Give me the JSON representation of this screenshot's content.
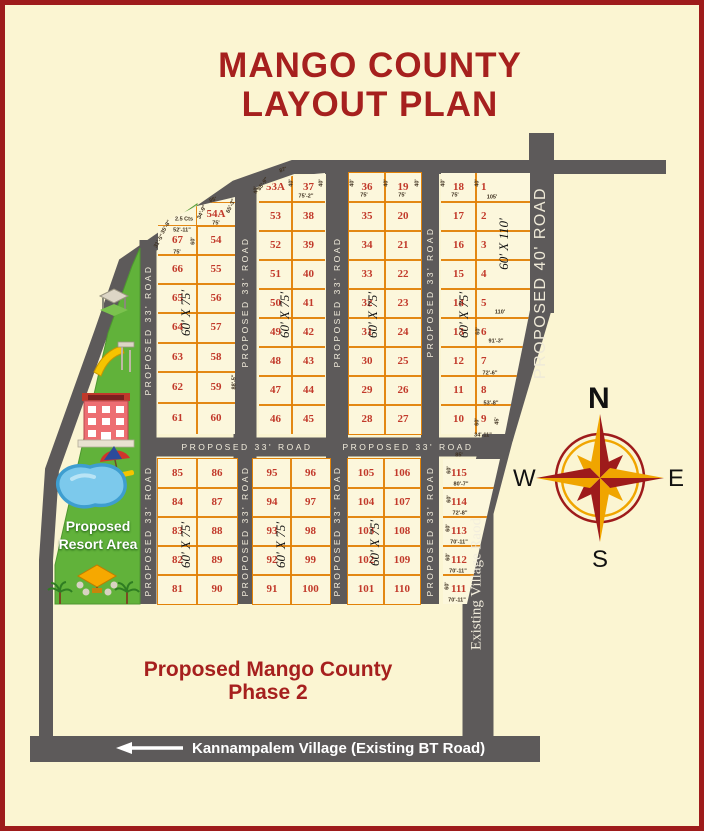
{
  "title": {
    "line1": "MANGO COUNTY",
    "line2": "LAYOUT PLAN"
  },
  "phase2": {
    "line1": "Proposed Mango County",
    "line2": "Phase 2"
  },
  "resort": {
    "line1": "Proposed",
    "line2": "Resort Area",
    "odd_plot_label": "2.5 Cts"
  },
  "bottom_road": {
    "label": "Kannampalem Village (Existing BT Road)",
    "arrow": "left"
  },
  "compass": {
    "n": "N",
    "s": "S",
    "e": "E",
    "w": "W"
  },
  "colors": {
    "background": "#FBF5D2",
    "border": "#9E1B1B",
    "road": "#5D5A5A",
    "plot_line": "#E28008",
    "plot_number": "#C23A2B",
    "title_red": "#A6201E",
    "resort_green": "#61B23A",
    "pool_blue": "#7CC9EC",
    "compass_gold": "#F0A500",
    "compass_red": "#9E1B1B"
  },
  "map": {
    "blocks": [
      {
        "x": 158,
        "y": 196,
        "w": 77,
        "h": 238,
        "clip": "polygon(0px 29px, 39px 10px, 77px 1px, 77px 238px, 0px 238px)",
        "cols": [
          {
            "dx": 0,
            "w": 39,
            "rows": [
              226,
              255,
              284,
              313,
              343,
              372,
              403,
              434
            ],
            "plots": [
              "67",
              "66",
              "65",
              "64",
              "63",
              "62",
              "61"
            ]
          },
          {
            "dx": 39,
            "w": 38,
            "rows": [
              203,
              226,
              255,
              284,
              313,
              343,
              372,
              403,
              434
            ],
            "plots": [
              "54A",
              "54",
              "55",
              "56",
              "57",
              "58",
              "59",
              "60"
            ]
          }
        ]
      },
      {
        "x": 259,
        "y": 173,
        "w": 66,
        "h": 261,
        "clip": "polygon(0px 16px, 33px 3px, 66px 0px, 66px 261px, 0px 261px)",
        "cols": [
          {
            "dx": 0,
            "w": 33,
            "rows": [
              173,
              202,
              231,
              260,
              289,
              318,
              347,
              376,
              405,
              434
            ],
            "plots": [
              "53A",
              "53",
              "52",
              "51",
              "50",
              "49",
              "48",
              "47",
              "46"
            ]
          },
          {
            "dx": 33,
            "w": 33,
            "rows": [
              173,
              202,
              231,
              260,
              289,
              318,
              347,
              376,
              405,
              434
            ],
            "plots": [
              "37",
              "38",
              "39",
              "40",
              "41",
              "42",
              "43",
              "44",
              "45"
            ]
          }
        ]
      },
      {
        "x": 349,
        "y": 173,
        "w": 72,
        "h": 261,
        "cols": [
          {
            "dx": 0,
            "w": 36,
            "rows": [
              173,
              202,
              231,
              260,
              289,
              318,
              347,
              376,
              405,
              434
            ],
            "plots": [
              "36",
              "35",
              "34",
              "33",
              "32",
              "31",
              "30",
              "29",
              "28"
            ]
          },
          {
            "dx": 36,
            "w": 36,
            "rows": [
              173,
              202,
              231,
              260,
              289,
              318,
              347,
              376,
              405,
              434
            ],
            "plots": [
              "19",
              "20",
              "21",
              "22",
              "23",
              "24",
              "25",
              "26",
              "27"
            ]
          }
        ]
      },
      {
        "x": 441,
        "y": 173,
        "w": 89,
        "h": 261,
        "clip": "polygon(0px 0px, 89px 0px, 89px 137px, 64px 261px, 0px 261px)",
        "cols": [
          {
            "dx": 0,
            "w": 35,
            "rows": [
              173,
              202,
              231,
              260,
              289,
              318,
              347,
              376,
              405,
              434
            ],
            "plots": [
              "18",
              "17",
              "16",
              "15",
              "14",
              "13",
              "12",
              "11",
              "10"
            ]
          },
          {
            "dx": 35,
            "w": 54,
            "nx": 14,
            "rows": [
              173,
              202,
              231,
              260,
              289,
              318,
              347,
              376,
              405,
              434
            ],
            "plots": [
              "1",
              "2",
              "3",
              "4",
              "5",
              "6",
              "7",
              "8",
              "9"
            ]
          }
        ]
      },
      {
        "x": 158,
        "y": 459,
        "w": 79,
        "h": 145,
        "cols": [
          {
            "dx": 0,
            "w": 39,
            "rows": [
              459,
              488,
              517,
              546,
              575,
              604
            ],
            "plots": [
              "85",
              "84",
              "83",
              "82",
              "81"
            ]
          },
          {
            "dx": 39,
            "w": 40,
            "rows": [
              459,
              488,
              517,
              546,
              575,
              604
            ],
            "plots": [
              "86",
              "87",
              "88",
              "89",
              "90"
            ]
          }
        ]
      },
      {
        "x": 253,
        "y": 459,
        "w": 77,
        "h": 145,
        "cols": [
          {
            "dx": 0,
            "w": 38,
            "rows": [
              459,
              488,
              517,
              546,
              575,
              604
            ],
            "plots": [
              "95",
              "94",
              "93",
              "92",
              "91"
            ]
          },
          {
            "dx": 38,
            "w": 39,
            "rows": [
              459,
              488,
              517,
              546,
              575,
              604
            ],
            "plots": [
              "96",
              "97",
              "98",
              "99",
              "100"
            ]
          }
        ]
      },
      {
        "x": 348,
        "y": 459,
        "w": 72,
        "h": 145,
        "cols": [
          {
            "dx": 0,
            "w": 36,
            "rows": [
              459,
              488,
              517,
              546,
              575,
              604
            ],
            "plots": [
              "105",
              "104",
              "103",
              "102",
              "101"
            ]
          },
          {
            "dx": 36,
            "w": 36,
            "rows": [
              459,
              488,
              517,
              546,
              575,
              604
            ],
            "plots": [
              "106",
              "107",
              "108",
              "109",
              "110"
            ]
          }
        ]
      },
      {
        "x": 443,
        "y": 459,
        "w": 57,
        "h": 145,
        "clip": "polygon(0px 0px, 57px 0px, 24px 145px, 0px 145px)",
        "cols": [
          {
            "dx": 0,
            "w": 57,
            "nx": 17,
            "rows": [
              459,
              488,
              517,
              546,
              575,
              604
            ],
            "plots": [
              "115",
              "114",
              "113",
              "112",
              "111"
            ]
          }
        ]
      }
    ],
    "labels": [
      {
        "t": "75'-2\"",
        "x": 306,
        "y": 196,
        "cls": "dim"
      },
      {
        "t": "75'",
        "x": 364,
        "y": 195,
        "cls": "dim"
      },
      {
        "t": "75'",
        "x": 402,
        "y": 195,
        "cls": "dim"
      },
      {
        "t": "75'",
        "x": 455,
        "y": 195,
        "cls": "dim"
      },
      {
        "t": "105'",
        "x": 492,
        "y": 197,
        "cls": "dim"
      },
      {
        "t": "75'",
        "x": 216,
        "y": 223,
        "cls": "dim"
      },
      {
        "t": "52'-11\"",
        "x": 182,
        "y": 230,
        "cls": "dim"
      },
      {
        "t": "75'",
        "x": 177,
        "y": 252,
        "cls": "dim"
      },
      {
        "t": "110'",
        "x": 500,
        "y": 312,
        "cls": "dim"
      },
      {
        "t": "91'-3\"",
        "x": 496,
        "y": 341,
        "cls": "dim"
      },
      {
        "t": "72'-6\"",
        "x": 490,
        "y": 373,
        "cls": "dim"
      },
      {
        "t": "53'-8\"",
        "x": 491,
        "y": 403,
        "cls": "dim"
      },
      {
        "t": "34'-11\"",
        "x": 483,
        "y": 435,
        "cls": "dim"
      },
      {
        "t": "85'",
        "x": 459,
        "y": 455,
        "cls": "dim"
      },
      {
        "t": "80'-7\"",
        "x": 461,
        "y": 484,
        "cls": "dim"
      },
      {
        "t": "72'-8\"",
        "x": 460,
        "y": 513,
        "cls": "dim"
      },
      {
        "t": "70'-11\"",
        "x": 459,
        "y": 542,
        "cls": "dim"
      },
      {
        "t": "70'-11\"",
        "x": 458,
        "y": 571,
        "cls": "dim"
      },
      {
        "t": "70'-11\"",
        "x": 457,
        "y": 600,
        "cls": "dim"
      },
      {
        "t": "40'",
        "x": 256,
        "y": 190,
        "r": -90,
        "cls": "dim"
      },
      {
        "t": "40'",
        "x": 291,
        "y": 183,
        "r": -90,
        "cls": "dim"
      },
      {
        "t": "40'",
        "x": 321,
        "y": 183,
        "r": -90,
        "cls": "dim"
      },
      {
        "t": "40'",
        "x": 352,
        "y": 183,
        "r": -90,
        "cls": "dim"
      },
      {
        "t": "40'",
        "x": 386,
        "y": 183,
        "r": -90,
        "cls": "dim"
      },
      {
        "t": "40'",
        "x": 417,
        "y": 183,
        "r": -90,
        "cls": "dim"
      },
      {
        "t": "40'",
        "x": 443,
        "y": 183,
        "r": -90,
        "cls": "dim"
      },
      {
        "t": "40'",
        "x": 477,
        "y": 183,
        "r": -90,
        "cls": "dim"
      },
      {
        "t": "60'",
        "x": 193,
        "y": 241,
        "r": -90,
        "cls": "dim"
      },
      {
        "t": "60'",
        "x": 478,
        "y": 331,
        "r": -90,
        "cls": "dim"
      },
      {
        "t": "60'",
        "x": 477,
        "y": 422,
        "r": -90,
        "cls": "dim"
      },
      {
        "t": "45'",
        "x": 497,
        "y": 421,
        "r": -90,
        "cls": "dim"
      },
      {
        "t": "60'",
        "x": 449,
        "y": 470,
        "r": -90,
        "cls": "dim"
      },
      {
        "t": "60'",
        "x": 449,
        "y": 499,
        "r": -90,
        "cls": "dim"
      },
      {
        "t": "60'",
        "x": 448,
        "y": 528,
        "r": -90,
        "cls": "dim"
      },
      {
        "t": "60'",
        "x": 448,
        "y": 557,
        "r": -90,
        "cls": "dim"
      },
      {
        "t": "60'",
        "x": 447,
        "y": 586,
        "r": -90,
        "cls": "dim"
      },
      {
        "t": "34'-9\"",
        "x": 202,
        "y": 212,
        "r": -65,
        "cls": "dim"
      },
      {
        "t": "65'-3\"",
        "x": 231,
        "y": 206,
        "r": -65,
        "cls": "dim"
      },
      {
        "t": "85'",
        "x": 213,
        "y": 200,
        "r": -20,
        "cls": "dim"
      },
      {
        "t": "85'-9\"",
        "x": 263,
        "y": 184,
        "r": -55,
        "cls": "dim"
      },
      {
        "t": "31'-5\"",
        "x": 159,
        "y": 241,
        "r": -60,
        "cls": "dim"
      },
      {
        "t": "35'-8\"",
        "x": 166,
        "y": 227,
        "r": -60,
        "cls": "dim"
      },
      {
        "t": "88'-5\"",
        "x": 234,
        "y": 382,
        "r": -90,
        "cls": "dim"
      },
      {
        "t": "87'",
        "x": 283,
        "y": 170,
        "r": -20,
        "cls": "dim"
      },
      {
        "t": "2.5 Cts",
        "x": 184,
        "y": 219,
        "cls": "dim"
      },
      {
        "t": "60' X 75'",
        "x": 186,
        "y": 313,
        "r": -90,
        "cls": "size"
      },
      {
        "t": "60' X 75'",
        "x": 285,
        "y": 315,
        "r": -90,
        "cls": "size"
      },
      {
        "t": "60' X 75'",
        "x": 373,
        "y": 315,
        "r": -90,
        "cls": "size"
      },
      {
        "t": "60' X 75'",
        "x": 464,
        "y": 315,
        "r": -90,
        "cls": "size"
      },
      {
        "t": "60' X 110'",
        "x": 504,
        "y": 244,
        "r": -90,
        "cls": "size"
      },
      {
        "t": "60' X 75'",
        "x": 186,
        "y": 545,
        "r": -90,
        "cls": "size"
      },
      {
        "t": "60' X 75'",
        "x": 281,
        "y": 545,
        "r": -90,
        "cls": "size"
      },
      {
        "t": "60' X 75'",
        "x": 375,
        "y": 543,
        "r": -90,
        "cls": "size"
      },
      {
        "t": "PROPOSED 33' ROAD",
        "x": 148,
        "y": 330,
        "r": -90,
        "cls": "roadv"
      },
      {
        "t": "PROPOSED 33' ROAD",
        "x": 148,
        "y": 531,
        "r": -90,
        "cls": "roadv"
      },
      {
        "t": "PROPOSED 33' ROAD",
        "x": 245,
        "y": 302,
        "r": -90,
        "cls": "roadv"
      },
      {
        "t": "PROPOSED 33' ROAD",
        "x": 245,
        "y": 531,
        "r": -90,
        "cls": "roadv"
      },
      {
        "t": "PROPOSED 33' ROAD",
        "x": 337,
        "y": 302,
        "r": -90,
        "cls": "roadv"
      },
      {
        "t": "PROPOSED 33' ROAD",
        "x": 337,
        "y": 531,
        "r": -90,
        "cls": "roadv"
      },
      {
        "t": "PROPOSED 33' ROAD",
        "x": 430,
        "y": 292,
        "r": -90,
        "cls": "roadv"
      },
      {
        "t": "PROPOSED 33' ROAD",
        "x": 430,
        "y": 531,
        "r": -90,
        "cls": "roadv"
      },
      {
        "t": "PROPOSED 33' ROAD",
        "x": 247,
        "y": 447,
        "cls": "roadh"
      },
      {
        "t": "PROPOSED 33' ROAD",
        "x": 408,
        "y": 447,
        "cls": "roadh"
      },
      {
        "t": "PROPOSED 40' ROAD",
        "x": 541,
        "y": 283,
        "r": -90,
        "cls": "road40"
      },
      {
        "t": "Existing Village Raod",
        "x": 477,
        "y": 584,
        "r": -90,
        "cls": "roadvil"
      }
    ]
  }
}
